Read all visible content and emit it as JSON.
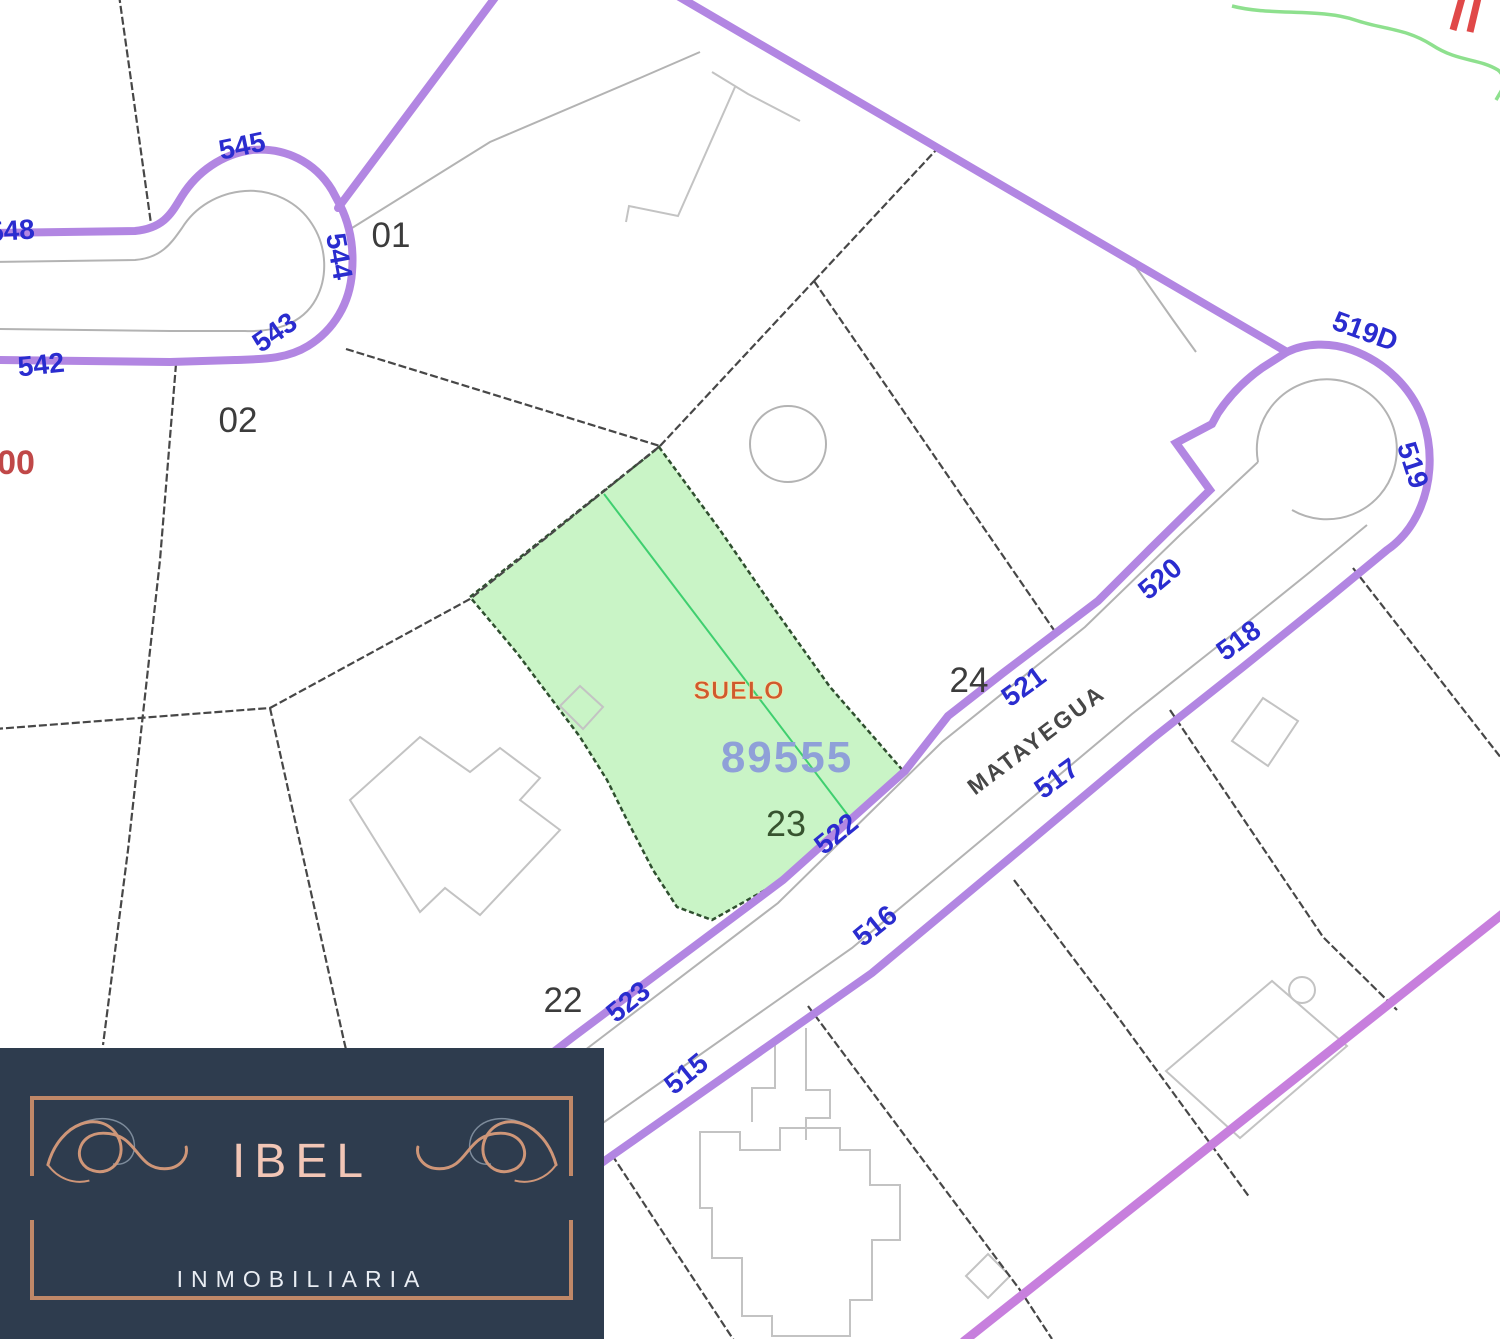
{
  "map": {
    "street_name": "MATAYEGUA",
    "highlighted_parcel": {
      "land_use": "SUELO",
      "cadastral_ref": "89555",
      "parcel_number": "23"
    },
    "partial_ref_left_edge": "00",
    "streets": {
      "s545": "545",
      "s548": "548",
      "s542": "542",
      "s543": "543",
      "s544": "544",
      "s519d": "519D",
      "s519": "519",
      "s520": "520",
      "s521": "521",
      "s522": "522",
      "s523": "523",
      "s518": "518",
      "s517": "517",
      "s516": "516",
      "s515": "515"
    },
    "parcels": {
      "p01": "01",
      "p02": "02",
      "p22": "22",
      "p24": "24"
    },
    "colors": {
      "road_purple": "#b286e2",
      "road_magenta": "#c77fdd",
      "street_number_blue": "#2a2ccf",
      "boundary_black": "#474747",
      "curb_gray": "#b3b3b3",
      "building_gray": "#c3c3c3",
      "parcel_green_fill": "#c9f4c6",
      "parcel_green_edge": "#2f4f2f",
      "divider_green": "#3fcf6f",
      "suelo_orange": "#cf5a2e",
      "ref_periwinkle": "#8fa0d8",
      "partial_red": "#c04848",
      "contour_green": "#8ee08e",
      "mark_red": "#e04848"
    }
  },
  "logo": {
    "brand": "IBEL",
    "tagline": "INMOBILIARIA",
    "colors": {
      "navy": "#2e3c4e",
      "rose_frame": "#c08868",
      "rose_text": "#f2c6b6",
      "white_text": "#e9edf3"
    }
  }
}
